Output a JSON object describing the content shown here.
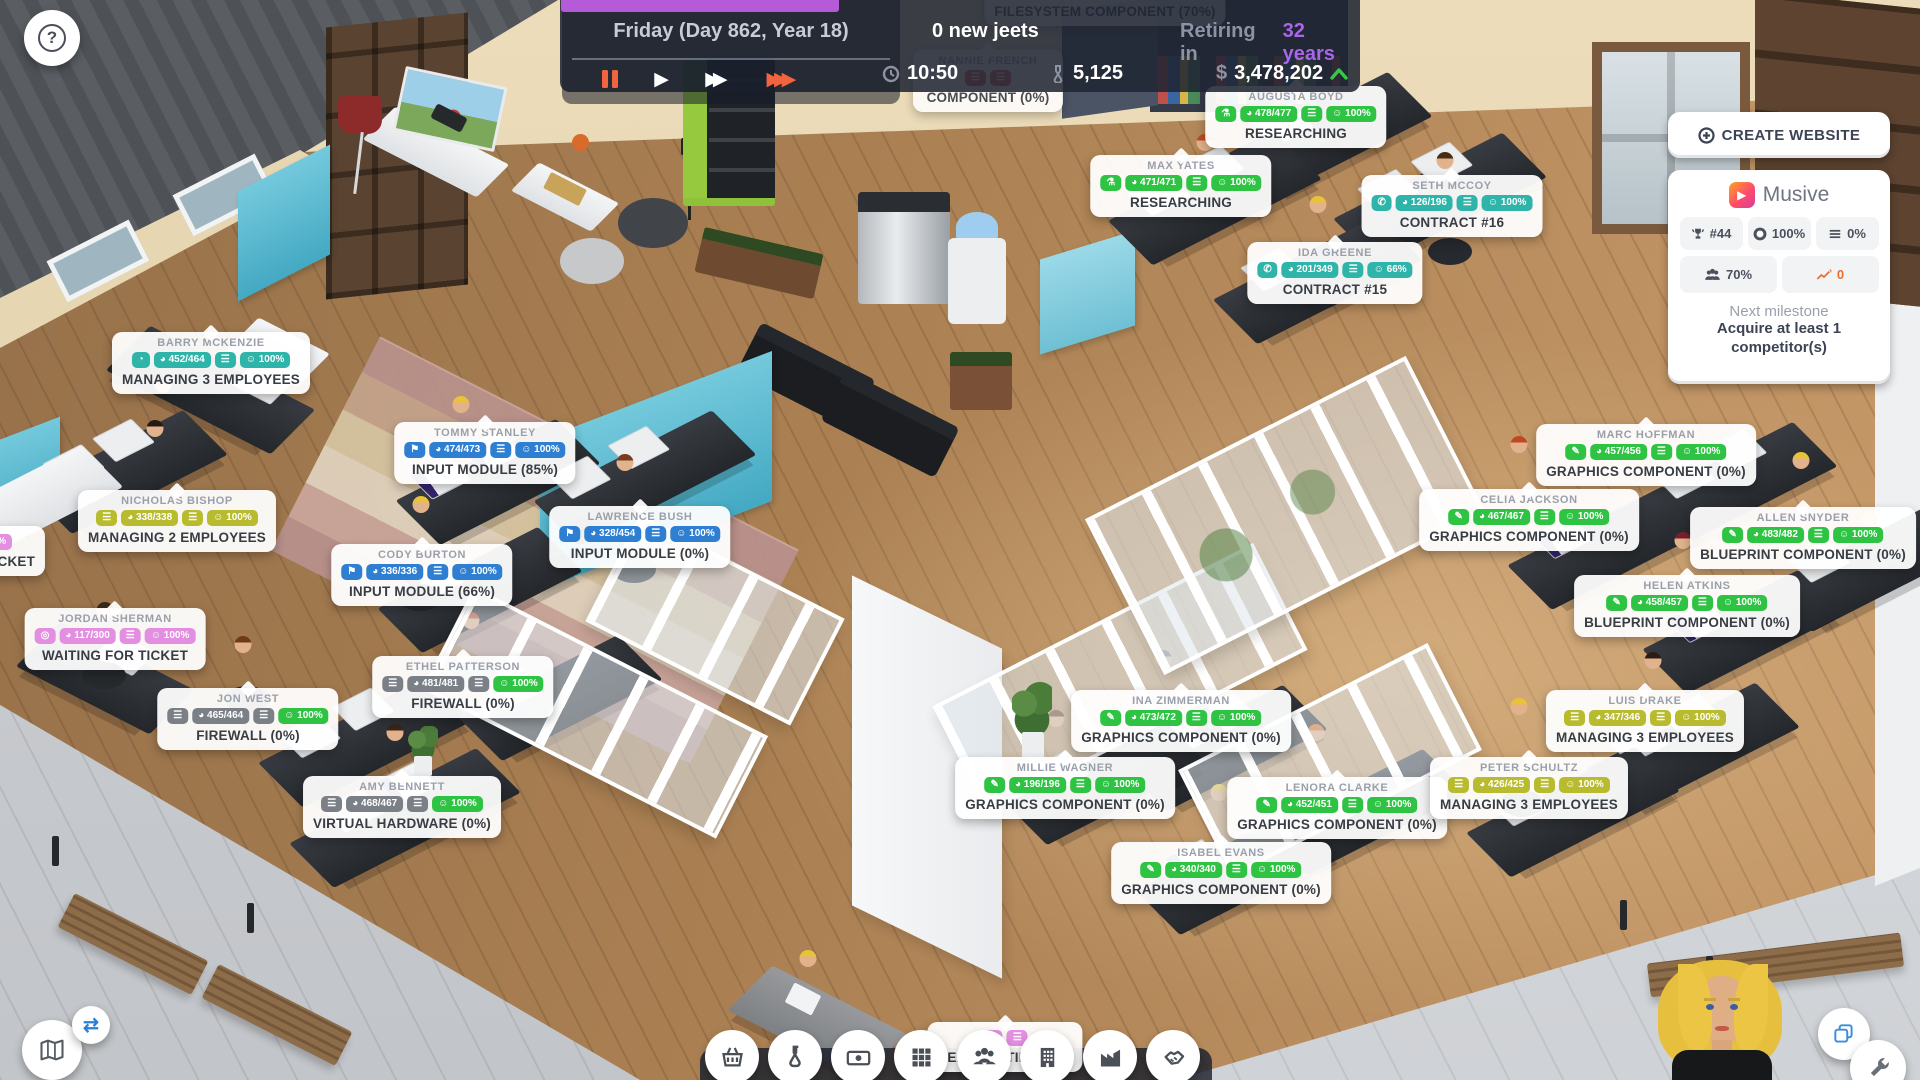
{
  "topbar": {
    "date": "Friday (Day 862, Year 18)",
    "new_jeets": "0 new jeets",
    "retiring_prefix": "Retiring in",
    "retiring_value": "32 years",
    "time": "10:50",
    "research_points": "5,125",
    "currency": "$",
    "money": "3,478,202"
  },
  "website_panel": {
    "create_button": "CREATE WEBSITE",
    "site_name": "Musive",
    "stats": [
      {
        "icon": "trophy-icon",
        "value": "#44"
      },
      {
        "icon": "lifebuoy-icon",
        "value": "100%"
      },
      {
        "icon": "queue-icon",
        "value": "0%"
      },
      {
        "icon": "users-icon",
        "value": "70%"
      },
      {
        "icon": "chart-icon",
        "value": "0"
      }
    ],
    "milestone_label": "Next milestone",
    "milestone_line1": "Acquire at least 1",
    "milestone_line2": "competitor(s)"
  },
  "toolbar": {
    "items": [
      "store",
      "research",
      "finances",
      "apps",
      "team",
      "building",
      "production",
      "deals"
    ]
  },
  "badge_colors": {
    "teal": "#2eb4a9",
    "green": "#2fc344",
    "blue": "#2e7fd1",
    "yellow": "#b9bb2e",
    "pink": "#e38ee0",
    "gray": "#7b8087",
    "red": "#e05044",
    "mood_green": "#2fc344"
  },
  "badge_icons": {
    "clock": "◔",
    "flag": "⚑",
    "phone": "✆",
    "pencil": "✎",
    "flask": "⚗",
    "life": "◎",
    "list": "☰",
    "gauge": "◕",
    "queue": "☰",
    "mood": "☺"
  },
  "employees": [
    {
      "name": "BARRY MCKENZIE",
      "icon": "clock",
      "speed": "452/464",
      "mood": "100%",
      "task": "MANAGING 3 EMPLOYEES",
      "color": "teal",
      "x": 211,
      "y": 332
    },
    {
      "name": "NICHOLAS BISHOP",
      "icon": "list",
      "speed": "338/338",
      "mood": "100%",
      "task": "MANAGING 2 EMPLOYEES",
      "color": "yellow",
      "x": 177,
      "y": 490
    },
    {
      "name": "TOMMY STANLEY",
      "icon": "flag",
      "speed": "474/473",
      "mood": "100%",
      "task": "INPUT MODULE (85%)",
      "color": "blue",
      "x": 485,
      "y": 422
    },
    {
      "name": "LAWRENCE BUSH",
      "icon": "flag",
      "speed": "328/454",
      "mood": "100%",
      "task": "INPUT MODULE (0%)",
      "color": "blue",
      "x": 640,
      "y": 506
    },
    {
      "name": "CODY BURTON",
      "icon": "flag",
      "speed": "336/336",
      "mood": "100%",
      "task": "INPUT MODULE (66%)",
      "color": "blue",
      "x": 422,
      "y": 544
    },
    {
      "name": "JORDAN SHERMAN",
      "icon": "life",
      "speed": "117/300",
      "mood": "100%",
      "task": "WAITING FOR TICKET",
      "color": "pink",
      "x": 115,
      "y": 608
    },
    {
      "name": "JON WEST",
      "icon": "list",
      "speed": "465/464",
      "mood": "100%",
      "task": "FIREWALL (0%)",
      "color": "gray",
      "x": 248,
      "y": 688
    },
    {
      "name": "ETHEL PATTERSON",
      "icon": "list",
      "speed": "481/481",
      "mood": "100%",
      "task": "FIREWALL (0%)",
      "color": "gray",
      "x": 463,
      "y": 656
    },
    {
      "name": "AMY BENNETT",
      "icon": "list",
      "speed": "468/467",
      "mood": "100%",
      "task": "VIRTUAL HARDWARE (0%)",
      "color": "gray",
      "x": 402,
      "y": 776
    },
    {
      "name": "AUGUSTA BOYD",
      "icon": "flask",
      "speed": "478/477",
      "mood": "100%",
      "task": "RESEARCHING",
      "color": "green",
      "x": 1296,
      "y": 86
    },
    {
      "name": "MAX YATES",
      "icon": "flask",
      "speed": "471/471",
      "mood": "100%",
      "task": "RESEARCHING",
      "color": "green",
      "x": 1181,
      "y": 155
    },
    {
      "name": "SETH MCCOY",
      "icon": "phone",
      "speed": "126/196",
      "mood": "100%",
      "task": "CONTRACT #16",
      "color": "teal",
      "x": 1452,
      "y": 175
    },
    {
      "name": "IDA GREENE",
      "icon": "phone",
      "speed": "201/349",
      "mood": "66%",
      "task": "CONTRACT #15",
      "color": "teal",
      "x": 1335,
      "y": 242
    },
    {
      "name": "MARC HOFFMAN",
      "icon": "pencil",
      "speed": "457/456",
      "mood": "100%",
      "task": "GRAPHICS COMPONENT (0%)",
      "color": "green",
      "x": 1646,
      "y": 424
    },
    {
      "name": "CELIA JACKSON",
      "icon": "pencil",
      "speed": "467/467",
      "mood": "100%",
      "task": "GRAPHICS COMPONENT (0%)",
      "color": "green",
      "x": 1529,
      "y": 489
    },
    {
      "name": "ALLEN SNYDER",
      "icon": "pencil",
      "speed": "483/482",
      "mood": "100%",
      "task": "BLUEPRINT COMPONENT (0%)",
      "color": "green",
      "x": 1803,
      "y": 507
    },
    {
      "name": "HELEN ATKINS",
      "icon": "pencil",
      "speed": "458/457",
      "mood": "100%",
      "task": "BLUEPRINT COMPONENT (0%)",
      "color": "green",
      "x": 1687,
      "y": 575
    },
    {
      "name": "INA ZIMMERMAN",
      "icon": "pencil",
      "speed": "473/472",
      "mood": "100%",
      "task": "GRAPHICS COMPONENT (0%)",
      "color": "green",
      "x": 1181,
      "y": 690
    },
    {
      "name": "MILLIE WAGNER",
      "icon": "pencil",
      "speed": "196/196",
      "mood": "100%",
      "task": "GRAPHICS COMPONENT (0%)",
      "color": "green",
      "x": 1065,
      "y": 757
    },
    {
      "name": "LENORA CLARKE",
      "icon": "pencil",
      "speed": "452/451",
      "mood": "100%",
      "task": "GRAPHICS COMPONENT (0%)",
      "color": "green",
      "x": 1337,
      "y": 777
    },
    {
      "name": "ISABEL EVANS",
      "icon": "pencil",
      "speed": "340/340",
      "mood": "100%",
      "task": "GRAPHICS COMPONENT (0%)",
      "color": "green",
      "x": 1221,
      "y": 842
    },
    {
      "name": "LUIS DRAKE",
      "icon": "list",
      "speed": "347/346",
      "mood": "100%",
      "task": "MANAGING 3 EMPLOYEES",
      "color": "yellow",
      "x": 1645,
      "y": 690
    },
    {
      "name": "PETER SCHULTZ",
      "icon": "list",
      "speed": "426/425",
      "mood": "100%",
      "task": "MANAGING 3 EMPLOYEES",
      "color": "yellow",
      "x": 1529,
      "y": 757
    },
    {
      "name": "NANNIE FRENCH",
      "icon": "list",
      "speed": "",
      "mood": "",
      "task": "COMPONENT (0%)",
      "color": "red",
      "x": 988,
      "y": 50,
      "faded": true
    },
    {
      "name": "",
      "icon": "list",
      "speed": "",
      "mood": "",
      "task": "FILESYSTEM COMPONENT (70%)",
      "color": "red",
      "x": 1105,
      "y": -24,
      "faded": true
    },
    {
      "name": "",
      "icon": "life",
      "speed": "",
      "mood": "",
      "task": "HEADHUNTING (0%)",
      "color": "pink",
      "x": 1005,
      "y": 1022,
      "z": 38
    },
    {
      "name": "",
      "icon": "life",
      "speed": "",
      "mood": "100%",
      "task": "WAITING FOR TICKET",
      "color": "pink",
      "x": -38,
      "y": 526
    }
  ]
}
